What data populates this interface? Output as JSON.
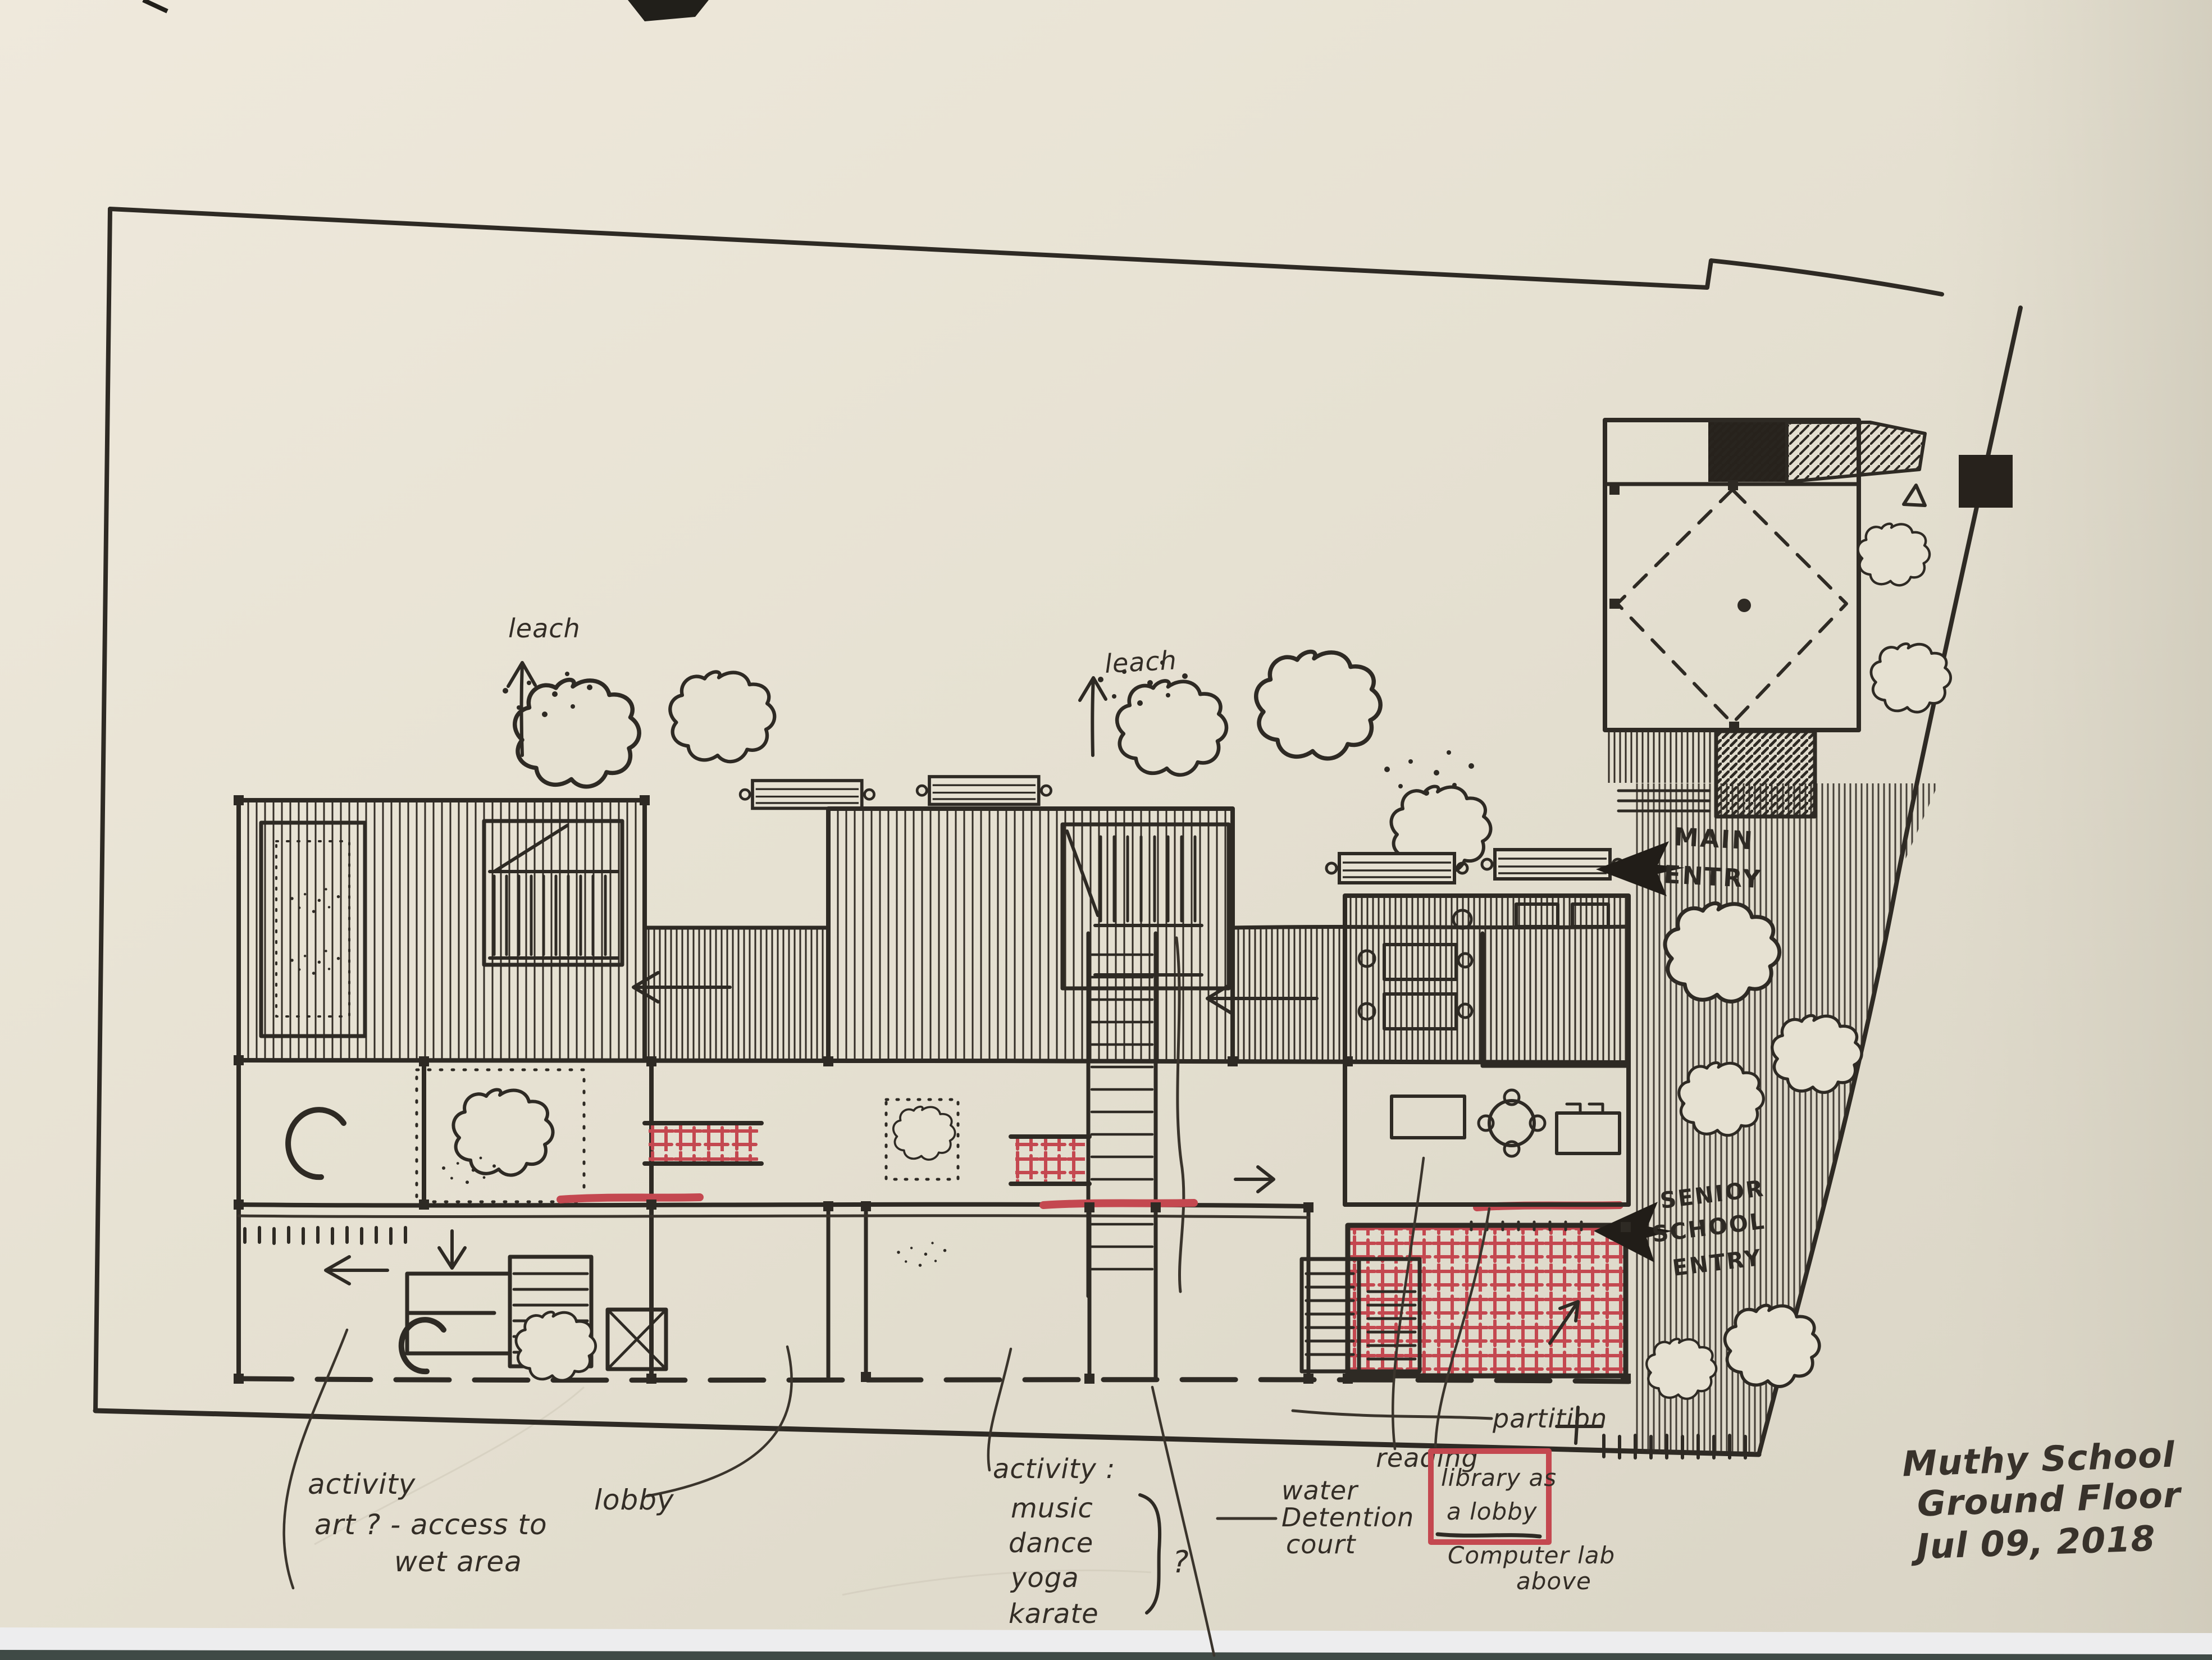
{
  "colors": {
    "paper": "#e6e1d2",
    "paper_light": "#efe9dc",
    "paper_dark": "#d7d2c3",
    "ink": "#2e2a24",
    "red_marker": "#c44850",
    "table": "#3f4a46",
    "under_sheet": "#efeff0"
  },
  "annotations": {
    "leach_left": "leach",
    "leach_right": "leach",
    "main_entry": {
      "line1": "MAIN",
      "line2": "ENTRY"
    },
    "senior_entry": {
      "line1": "SENIOR",
      "line2": "SCHOOL",
      "line3": "ENTRY"
    },
    "partition": "partition",
    "activity_art": {
      "line1": "activity",
      "line2": "art ? - access to",
      "line3": "wet area"
    },
    "lobby": "lobby",
    "activity_list": {
      "line1": "activity :",
      "line2": "music",
      "line3": "dance",
      "line4": "yoga",
      "line5": "karate",
      "question": "?"
    },
    "water_court": {
      "line1": "water",
      "line2": "Detention",
      "line3": "court"
    },
    "reading": "reading",
    "library_box": {
      "line1": "library as",
      "line2": "a lobby"
    },
    "computer_lab": {
      "line1": "Computer lab",
      "line2": "above"
    },
    "title_block": {
      "line1": "Muthy School",
      "line2": "Ground Floor",
      "line3": "Jul 09, 2018"
    }
  }
}
